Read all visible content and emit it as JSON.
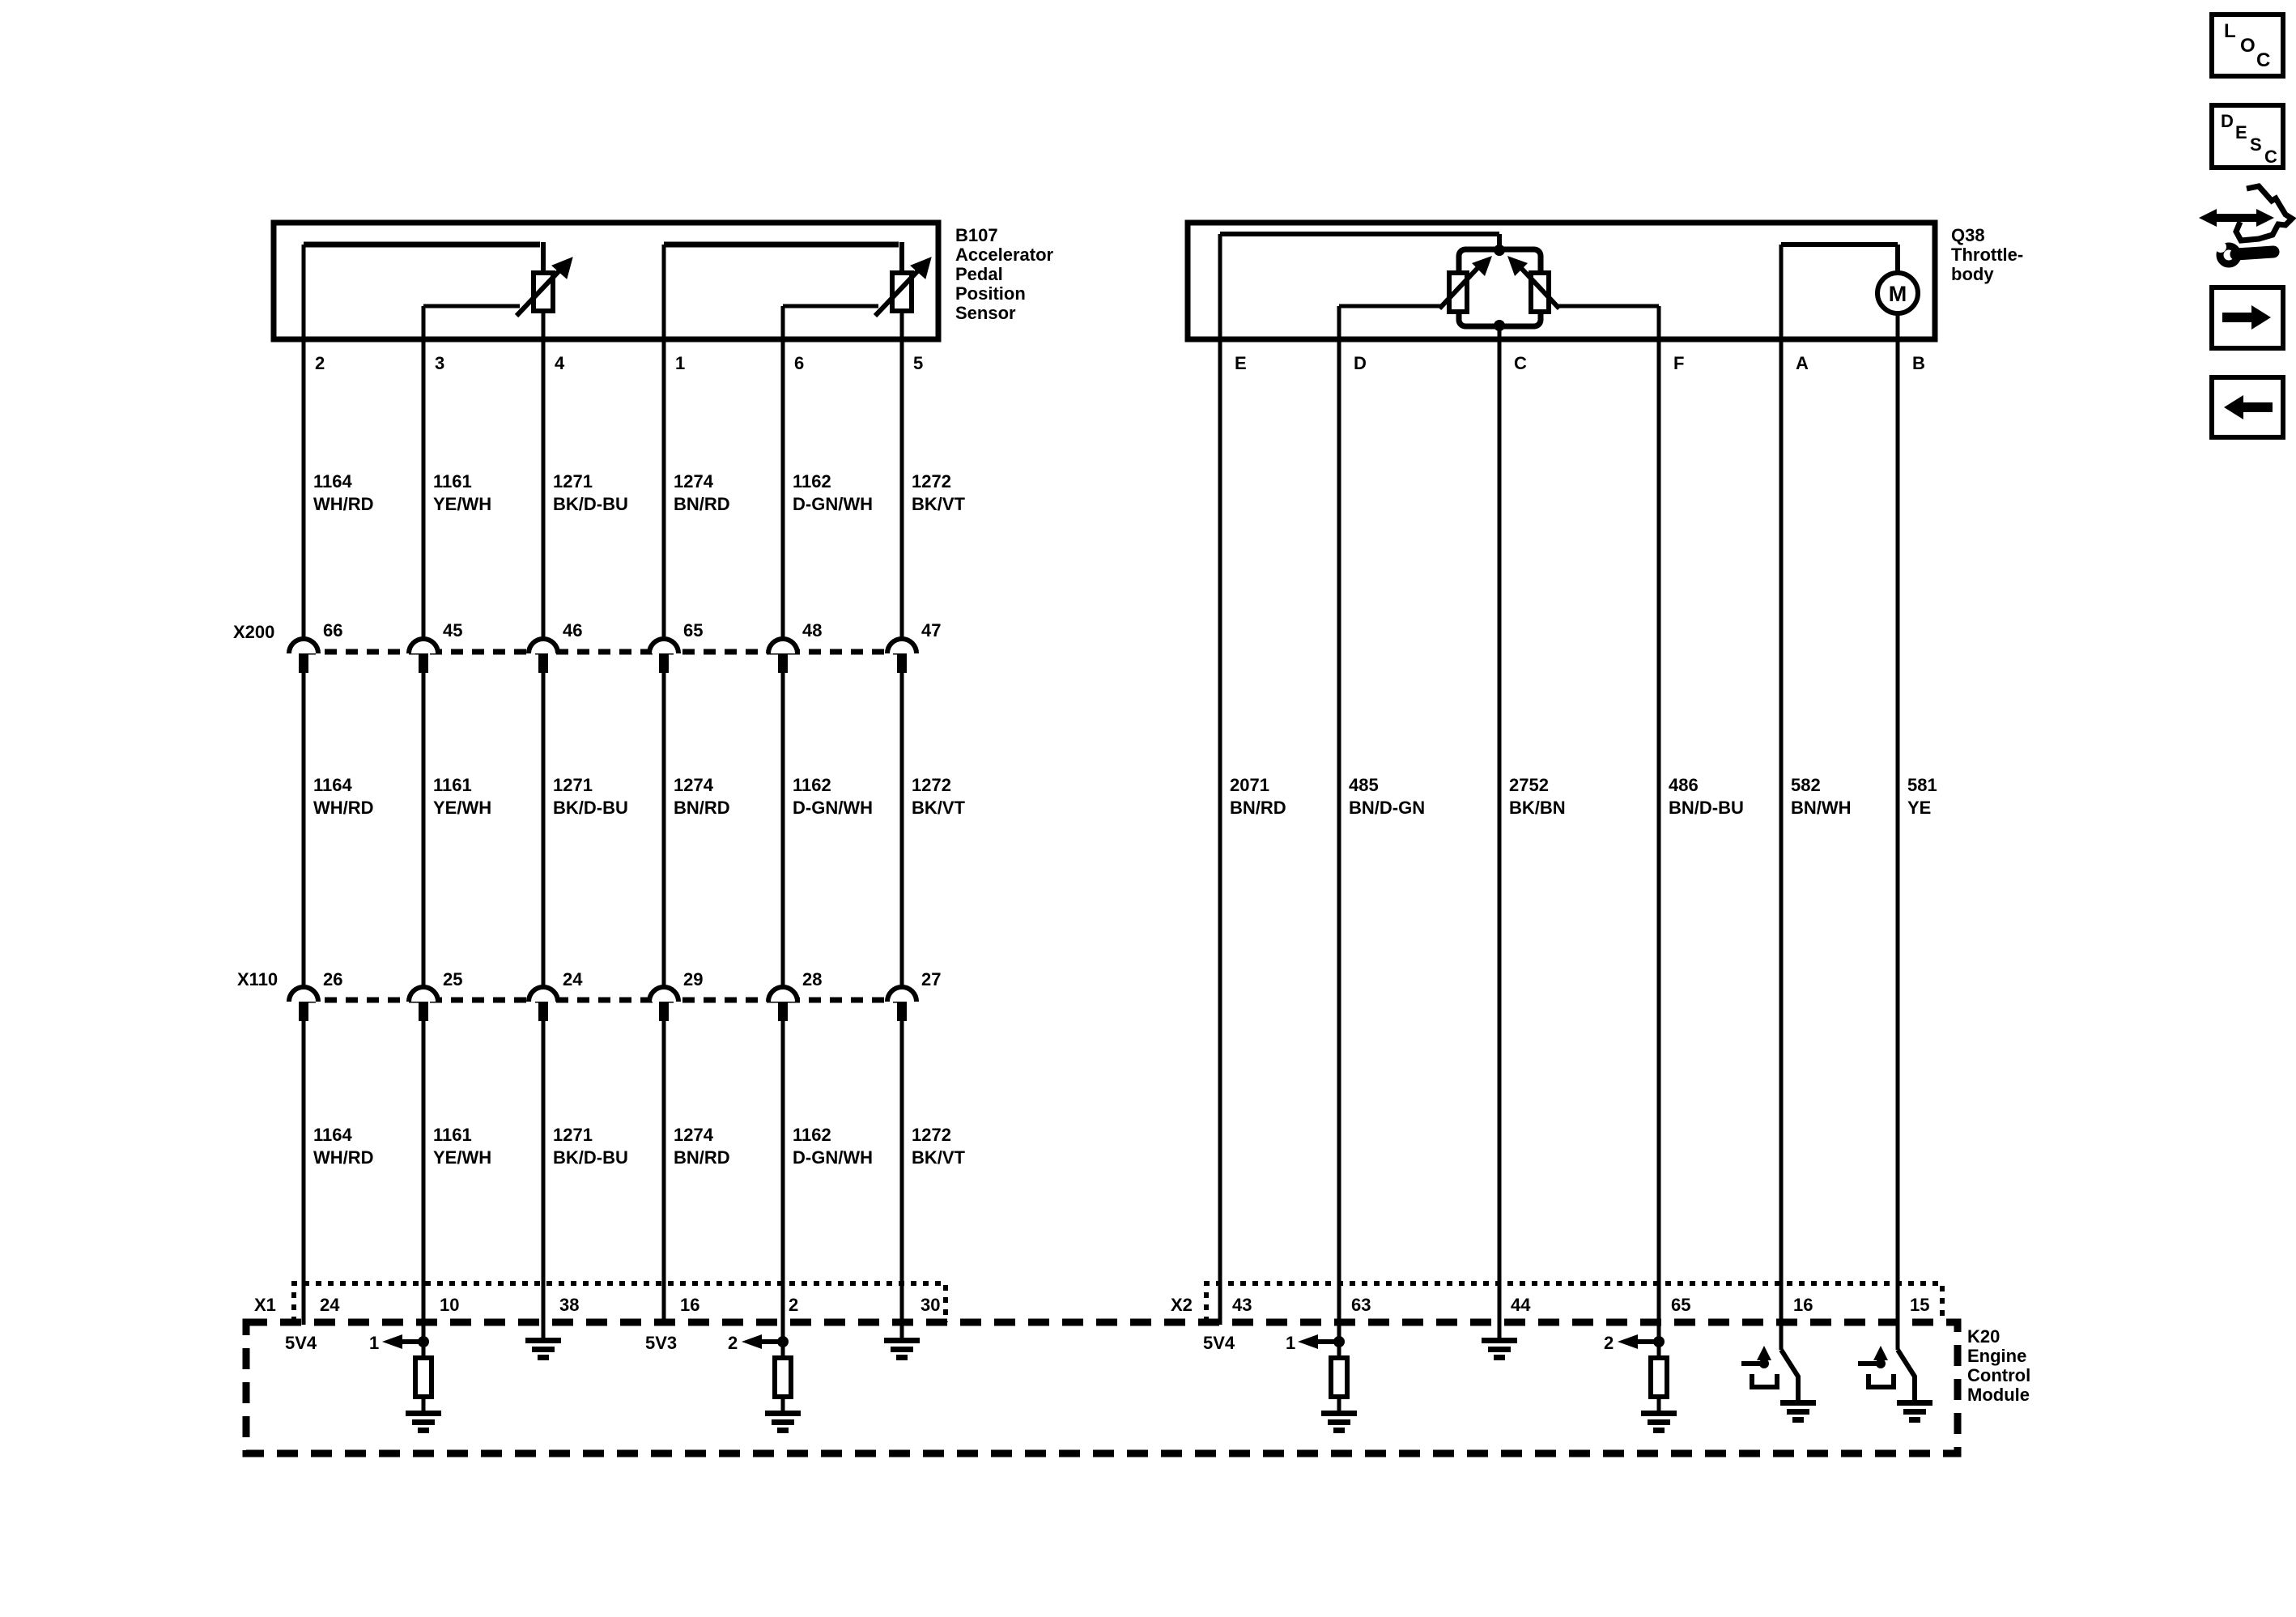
{
  "page": {
    "background": "#ffffff",
    "line_color": "#000000"
  },
  "b107": {
    "id": "B107",
    "name_lines": [
      "Accelerator",
      "Pedal",
      "Position",
      "Sensor"
    ],
    "pins": [
      "2",
      "3",
      "4",
      "1",
      "6",
      "5"
    ]
  },
  "q38": {
    "id": "Q38",
    "name_lines": [
      "Throttle-",
      "body"
    ],
    "pins": [
      "E",
      "D",
      "C",
      "F",
      "A",
      "B"
    ],
    "motor_label": "M"
  },
  "k20": {
    "name_lines": [
      "K20",
      "Engine",
      "Control",
      "Module"
    ],
    "refs_left": {
      "ref_5v_1": "5V4",
      "arrow_1": "1",
      "ref_5v_2": "5V3",
      "arrow_2": "2"
    },
    "refs_right": {
      "ref_5v_1": "5V4",
      "arrow_1": "1",
      "arrow_2": "2"
    }
  },
  "connectors": {
    "x200": {
      "label": "X200",
      "cavities": [
        "66",
        "45",
        "46",
        "65",
        "48",
        "47"
      ]
    },
    "x110": {
      "label": "X110",
      "cavities": [
        "26",
        "25",
        "24",
        "29",
        "28",
        "27"
      ]
    },
    "x1": {
      "label": "X1",
      "cavities": [
        "24",
        "10",
        "38",
        "16",
        "2",
        "30"
      ]
    },
    "x2": {
      "label": "X2",
      "cavities": [
        "43",
        "63",
        "44",
        "65",
        "16",
        "15"
      ]
    }
  },
  "wires_left": [
    {
      "circuit": "1164",
      "color": "WH/RD"
    },
    {
      "circuit": "1161",
      "color": "YE/WH"
    },
    {
      "circuit": "1271",
      "color": "BK/D-BU"
    },
    {
      "circuit": "1274",
      "color": "BN/RD"
    },
    {
      "circuit": "1162",
      "color": "D-GN/WH"
    },
    {
      "circuit": "1272",
      "color": "BK/VT"
    }
  ],
  "wires_right": [
    {
      "circuit": "2071",
      "color": "BN/RD"
    },
    {
      "circuit": "485",
      "color": "BN/D-GN"
    },
    {
      "circuit": "2752",
      "color": "BK/BN"
    },
    {
      "circuit": "486",
      "color": "BN/D-BU"
    },
    {
      "circuit": "582",
      "color": "BN/WH"
    },
    {
      "circuit": "581",
      "color": "YE"
    }
  ],
  "toolbar": {
    "loc_letters": [
      "L",
      "O",
      "C"
    ],
    "desc_letters": [
      "D",
      "E",
      "S",
      "C"
    ]
  }
}
